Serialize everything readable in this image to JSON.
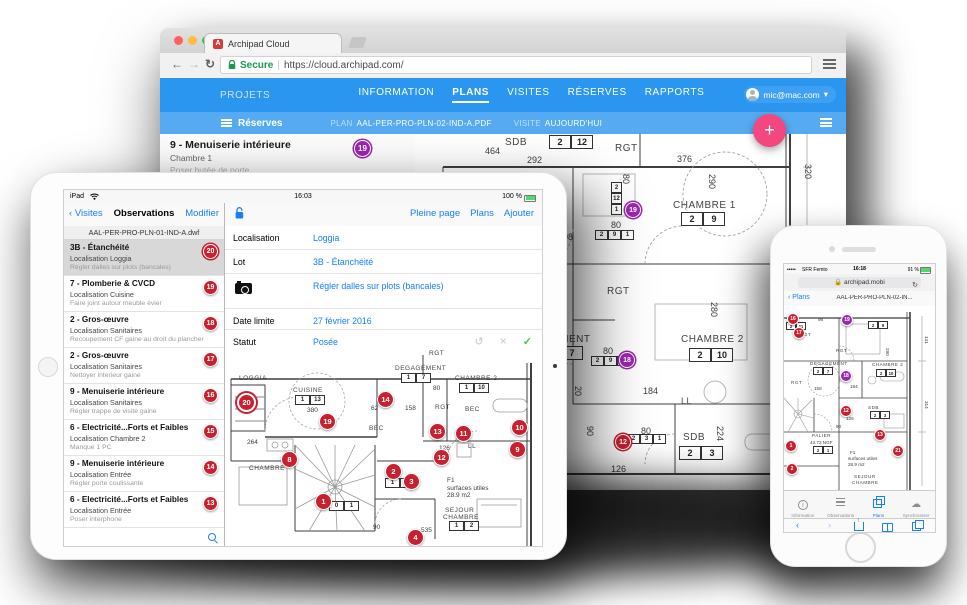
{
  "colors": {
    "navbar_blue": "#2B96EF",
    "subbar_blue": "#55AAF1",
    "ios_blue": "#157EFB",
    "marker_red": "#C8202E",
    "marker_purple": "#9C27B0",
    "fab_pink": "#F2477F",
    "check_green": "#44C94A",
    "secure_green": "#199A4C"
  },
  "browser": {
    "tab_title": "Archipad Cloud",
    "favicon_letter": "A",
    "secure_label": "Secure",
    "url": "https://cloud.archipad.com/",
    "navbar": {
      "projects": "PROJETS",
      "items": [
        {
          "label": "INFORMATION"
        },
        {
          "label": "PLANS",
          "cls": "active"
        },
        {
          "label": "VISITES"
        },
        {
          "label": "RÉSERVES"
        },
        {
          "label": "RAPPORTS"
        }
      ],
      "account": "mic@mac.com",
      "account_caret": "▾"
    },
    "subbar": {
      "reserves": "Réserves",
      "plan_label": "PLAN",
      "plan_value": "AAL-PER-PRO-PLN-02-IND-A.PDF",
      "visite_label": "VISITE",
      "visite_value": "AUJOURD'HUI",
      "fab": "+"
    },
    "list_item": {
      "title": "9 - Menuiserie intérieure",
      "loc": "Chambre 1",
      "note": "Poser butée de porte",
      "badge": "19"
    },
    "plan": {
      "labels": [
        {
          "t": "464",
          "x": 70,
          "y": 12
        },
        {
          "t": "SDB",
          "x": 90,
          "y": 3,
          "cls": "lg room"
        },
        {
          "t": "292",
          "x": 112,
          "y": 21
        },
        {
          "t": "RGT",
          "x": 200,
          "y": 9,
          "cls": "lg room"
        },
        {
          "t": "376",
          "x": 262,
          "y": 20
        },
        {
          "t": "290",
          "x": 292,
          "y": 40,
          "cls": "v"
        },
        {
          "t": "320",
          "x": 388,
          "y": 30,
          "cls": "v"
        },
        {
          "t": "80",
          "x": 206,
          "y": 40,
          "cls": "v"
        },
        {
          "t": "CHAMBRE 1",
          "x": 258,
          "y": 66,
          "cls": "lg room"
        },
        {
          "t": "80",
          "x": 196,
          "y": 86
        },
        {
          "t": "98",
          "x": 148,
          "y": 98
        },
        {
          "t": "RGT",
          "x": 192,
          "y": 152,
          "cls": "lg room"
        },
        {
          "t": "280",
          "x": 294,
          "y": 168,
          "cls": "v"
        },
        {
          "t": "CHAMBRE 2",
          "x": 266,
          "y": 200,
          "cls": "lg room"
        },
        {
          "t": "EMENT",
          "x": 138,
          "y": 200,
          "cls": "lg room"
        },
        {
          "t": "80",
          "x": 188,
          "y": 212
        },
        {
          "t": "184",
          "x": 228,
          "y": 252
        },
        {
          "t": "LL",
          "x": 266,
          "y": 262,
          "cls": "room"
        },
        {
          "t": "80",
          "x": 226,
          "y": 292
        },
        {
          "t": "SDB",
          "x": 268,
          "y": 298,
          "cls": "lg room"
        },
        {
          "t": "224",
          "x": 300,
          "y": 292,
          "cls": "v"
        },
        {
          "t": "90",
          "x": 170,
          "y": 292,
          "cls": "v"
        },
        {
          "t": "20",
          "x": 158,
          "y": 252,
          "cls": "v"
        },
        {
          "t": "126",
          "x": 196,
          "y": 330
        },
        {
          "t": "98",
          "x": 120,
          "y": 236
        }
      ],
      "boxes": [
        {
          "cells": [
            "2",
            "12"
          ],
          "x": 134,
          "y": 1
        },
        {
          "cells": [
            "2",
            "9"
          ],
          "x": 266,
          "y": 78
        },
        {
          "cells": [
            "2",
            "9",
            "1"
          ],
          "x": 180,
          "y": 96,
          "cls": "sm"
        },
        {
          "cells": [
            "2",
            "12",
            "1"
          ],
          "x": 196,
          "y": 48,
          "cls": "smv"
        },
        {
          "cells": [
            "7"
          ],
          "x": 146,
          "y": 212
        },
        {
          "cells": [
            "2",
            "10"
          ],
          "x": 274,
          "y": 214
        },
        {
          "cells": [
            "2",
            "9",
            "1"
          ],
          "x": 176,
          "y": 222,
          "cls": "sm"
        },
        {
          "cells": [
            "2",
            "3",
            "1"
          ],
          "x": 212,
          "y": 300,
          "cls": "sm"
        },
        {
          "cells": [
            "2",
            "3"
          ],
          "x": 264,
          "y": 312
        },
        {
          "cells": [
            "2",
            "7",
            "1"
          ],
          "x": 118,
          "y": 286,
          "cls": "smv"
        }
      ],
      "markers": [
        {
          "n": "19",
          "x": 210,
          "y": 68,
          "cls": "purple out"
        },
        {
          "n": "18",
          "x": 204,
          "y": 218,
          "cls": "purple out"
        },
        {
          "n": "12",
          "x": 200,
          "y": 300,
          "cls": "red out"
        }
      ]
    }
  },
  "ipad": {
    "status": {
      "left": "iPad",
      "time": "16:03",
      "battery": "100 %"
    },
    "toolbar": {
      "back": "Visites",
      "title": "Observations",
      "edit": "Modifier",
      "actions": [
        {
          "label": "Pleine page"
        },
        {
          "label": "Plans"
        },
        {
          "label": "Ajouter"
        }
      ]
    },
    "file_header": "AAL-PER-PRO-PLN-01-IND-A.dwf",
    "observations": [
      {
        "n": "20",
        "title": "3B - Étanchéité",
        "loc": "Localisation Loggia",
        "note": "Régler dalles sur plots (bancales)",
        "cls": "selected",
        "mcls": "ring"
      },
      {
        "n": "19",
        "title": "7 - Plomberie & CVCD",
        "loc": "Localisation Cuisine",
        "note": "Faire joint autour meuble évier"
      },
      {
        "n": "18",
        "title": "2 - Gros-œuvre",
        "loc": "Localisation Sanitaires",
        "note": "Recoupement CF gaine au droit du plancher"
      },
      {
        "n": "17",
        "title": "2 - Gros-œuvre",
        "loc": "Localisation Sanitaires",
        "note": "Nettoyer interieur gaine"
      },
      {
        "n": "16",
        "title": "9 - Menuiserie intérieure",
        "loc": "Localisation Sanitaires",
        "note": "Régler trappe de visite gaine"
      },
      {
        "n": "15",
        "title": "6 - Electricité...Forts et Faibles",
        "loc": "Localisation Chambre 2",
        "note": "Manque 1 PC"
      },
      {
        "n": "14",
        "title": "9 - Menuiserie intérieure",
        "loc": "Localisation Entrée",
        "note": "Régler porte coulissante"
      },
      {
        "n": "13",
        "title": "6 - Electricité...Forts et Faibles",
        "loc": "Localisation Entrée",
        "note": "Poser interphone"
      }
    ],
    "detail": {
      "loc_label": "Localisation",
      "loc_value": "Loggia",
      "lot_label": "Lot",
      "lot_value": "3B - Étanchéité",
      "note_value": "Régler dalles sur plots (bancales)",
      "date_label": "Date limite",
      "date_value": "27 février 2016",
      "statut_label": "Statut",
      "statut_value": "Posée"
    },
    "plan": {
      "labels": [
        {
          "t": "LOGGIA",
          "x": 14,
          "y": 26,
          "cls": "room"
        },
        {
          "t": "CUISINE",
          "x": 68,
          "y": 38,
          "cls": "room"
        },
        {
          "t": "380",
          "x": 82,
          "y": 58
        },
        {
          "t": "DEGAGEMENT",
          "x": 170,
          "y": 16,
          "cls": "room"
        },
        {
          "t": "RGT",
          "x": 204,
          "y": 1,
          "cls": "room"
        },
        {
          "t": "CHAMBRE 2",
          "x": 230,
          "y": 26,
          "cls": "room"
        },
        {
          "t": "RGT",
          "x": 210,
          "y": 55,
          "cls": "room"
        },
        {
          "t": "BEC",
          "x": 240,
          "y": 57,
          "cls": "room"
        },
        {
          "t": "BEC",
          "x": 144,
          "y": 76,
          "cls": "room"
        },
        {
          "t": "62",
          "x": 146,
          "y": 56
        },
        {
          "t": "158",
          "x": 180,
          "y": 56
        },
        {
          "t": "80",
          "x": 208,
          "y": 36
        },
        {
          "t": "LL",
          "x": 243,
          "y": 94,
          "cls": "room"
        },
        {
          "t": "126",
          "x": 214,
          "y": 96
        },
        {
          "t": "264",
          "x": 22,
          "y": 90
        },
        {
          "t": "CHAMBRE",
          "x": 24,
          "y": 116,
          "cls": "room"
        },
        {
          "t": "F1",
          "x": 222,
          "y": 128
        },
        {
          "t": "surfaces utiles",
          "x": 222,
          "y": 136
        },
        {
          "t": "28.9 m2",
          "x": 222,
          "y": 143
        },
        {
          "t": "SEJOUR",
          "x": 220,
          "y": 158,
          "cls": "room"
        },
        {
          "t": "CHAMBRE",
          "x": 218,
          "y": 165,
          "cls": "room"
        },
        {
          "t": "90",
          "x": 148,
          "y": 175
        },
        {
          "t": "535",
          "x": 196,
          "y": 178
        }
      ],
      "boxes": [
        {
          "cells": [
            "1",
            "13"
          ],
          "x": 70,
          "y": 46
        },
        {
          "cells": [
            "1",
            "7"
          ],
          "x": 176,
          "y": 24
        },
        {
          "cells": [
            "1",
            "10"
          ],
          "x": 234,
          "y": 34
        },
        {
          "cells": [
            "1",
            "1"
          ],
          "x": 160,
          "y": 129
        },
        {
          "cells": [
            "1",
            "2"
          ],
          "x": 224,
          "y": 172
        },
        {
          "cells": [
            "0",
            "1"
          ],
          "x": 104,
          "y": 152
        }
      ],
      "markers": [
        {
          "n": "20",
          "x": 12,
          "y": 44,
          "cls": "big ring"
        },
        {
          "n": "19",
          "x": 94,
          "y": 64
        },
        {
          "n": "14",
          "x": 152,
          "y": 42
        },
        {
          "n": "13",
          "x": 204,
          "y": 74
        },
        {
          "n": "11",
          "x": 230,
          "y": 76
        },
        {
          "n": "10",
          "x": 286,
          "y": 70
        },
        {
          "n": "12",
          "x": 208,
          "y": 100
        },
        {
          "n": "9",
          "x": 284,
          "y": 92
        },
        {
          "n": "8",
          "x": 56,
          "y": 102
        },
        {
          "n": "2",
          "x": 160,
          "y": 114
        },
        {
          "n": "3",
          "x": 178,
          "y": 124
        },
        {
          "n": "1",
          "x": 90,
          "y": 144
        },
        {
          "n": "4",
          "x": 182,
          "y": 180
        }
      ]
    }
  },
  "iphone": {
    "status": {
      "carrier": "SFR Femto",
      "time": "16:18",
      "battery": "91 %"
    },
    "url": "archipad.mobi",
    "back": "Plans",
    "title": "AAL-PER-PRO-PLN-02-IN...",
    "tabs": [
      {
        "label": "Information"
      },
      {
        "label": "Observations"
      },
      {
        "label": "Plans",
        "cls": "active"
      },
      {
        "label": "Synchroniser"
      }
    ],
    "plan": {
      "labels": [
        {
          "t": "98",
          "x": 34,
          "y": 11
        },
        {
          "t": "RGT",
          "x": 16,
          "y": 26,
          "cls": "room"
        },
        {
          "t": "RGT",
          "x": 52,
          "y": 42,
          "cls": "room"
        },
        {
          "t": "290",
          "x": 101,
          "y": 42,
          "cls": "v"
        },
        {
          "t": "DEGAGEMENT",
          "x": 26,
          "y": 55,
          "cls": "room"
        },
        {
          "t": "CHAMBRE 2",
          "x": 88,
          "y": 56,
          "cls": "room"
        },
        {
          "t": "RGT",
          "x": 7,
          "y": 74,
          "cls": "room"
        },
        {
          "t": "158",
          "x": 30,
          "y": 80
        },
        {
          "t": "184",
          "x": 66,
          "y": 78
        },
        {
          "t": "SDB",
          "x": 84,
          "y": 99,
          "cls": "room"
        },
        {
          "t": "126",
          "x": 62,
          "y": 110
        },
        {
          "t": "90",
          "x": 52,
          "y": 118
        },
        {
          "t": "PALIER",
          "x": 28,
          "y": 127,
          "cls": "room"
        },
        {
          "t": "43.72 NGF",
          "x": 26,
          "y": 134
        },
        {
          "t": "F1",
          "x": 66,
          "y": 144
        },
        {
          "t": "surfaces utiles",
          "x": 64,
          "y": 150
        },
        {
          "t": "28.9 m2",
          "x": 64,
          "y": 156
        },
        {
          "t": "SEJOUR",
          "x": 70,
          "y": 168,
          "cls": "room"
        },
        {
          "t": "CHAMBRE",
          "x": 68,
          "y": 174,
          "cls": "room"
        },
        {
          "t": "141",
          "x": 140,
          "y": 30,
          "cls": "v"
        },
        {
          "t": "314",
          "x": 140,
          "y": 95,
          "cls": "v"
        }
      ],
      "boxes": [
        {
          "cells": [
            "2",
            "11"
          ],
          "x": 2,
          "y": 16
        },
        {
          "cells": [
            "2",
            "9"
          ],
          "x": 84,
          "y": 15
        },
        {
          "cells": [
            "2",
            "7"
          ],
          "x": 29,
          "y": 61
        },
        {
          "cells": [
            "2",
            "10"
          ],
          "x": 92,
          "y": 63
        },
        {
          "cells": [
            "2",
            "3"
          ],
          "x": 86,
          "y": 105
        },
        {
          "cells": [
            "2",
            "1"
          ],
          "x": 29,
          "y": 140
        }
      ],
      "markers": [
        {
          "n": "16",
          "x": 3,
          "y": 7
        },
        {
          "n": "17",
          "x": 9,
          "y": 21
        },
        {
          "n": "19",
          "x": 57,
          "y": 8,
          "cls": "purple"
        },
        {
          "n": "18",
          "x": 56,
          "y": 64,
          "cls": "purple"
        },
        {
          "n": "12",
          "x": 56,
          "y": 99
        },
        {
          "n": "13",
          "x": 90,
          "y": 123
        },
        {
          "n": "1",
          "x": 1,
          "y": 134
        },
        {
          "n": "2",
          "x": 2,
          "y": 157
        },
        {
          "n": "21",
          "x": 108,
          "y": 139
        }
      ]
    }
  }
}
